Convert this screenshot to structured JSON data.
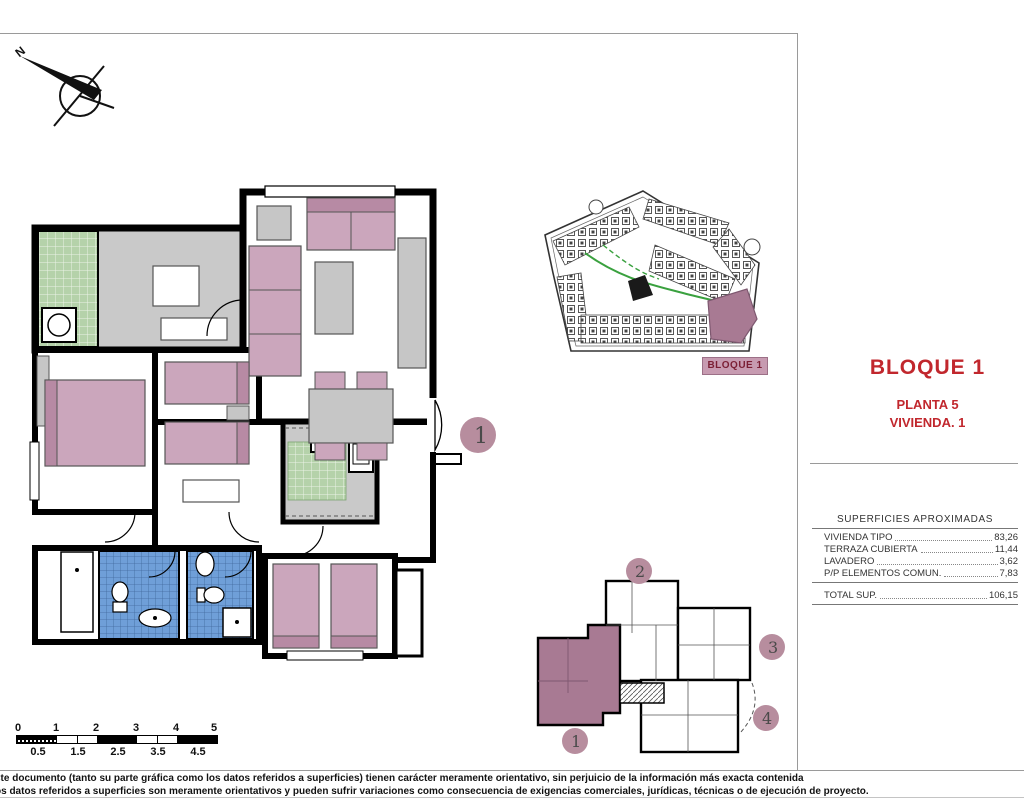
{
  "page": {
    "compass_label": "N"
  },
  "title_block": {
    "bloque": "BLOQUE 1",
    "planta": "PLANTA 5",
    "vivienda": "VIVIENDA. 1"
  },
  "areas_table": {
    "header": "SUPERFICIES APROXIMADAS",
    "rows": [
      {
        "label": "VIVIENDA TIPO",
        "value": "83,26"
      },
      {
        "label": "TERRAZA CUBIERTA",
        "value": "11,44"
      },
      {
        "label": "LAVADERO",
        "value": "3,62"
      },
      {
        "label": "P/P ELEMENTOS COMUN.",
        "value": "7,83"
      }
    ],
    "total": {
      "label": "TOTAL SUP.",
      "value": "106,15"
    }
  },
  "site_plan": {
    "label": "BLOQUE 1"
  },
  "key_plan": {
    "units": [
      "1",
      "2",
      "3",
      "4"
    ],
    "highlighted_unit": "1"
  },
  "unit_badge": "1",
  "scale_bar": {
    "top_labels": [
      "0",
      "1",
      "2",
      "3",
      "4",
      "5"
    ],
    "bottom_labels": [
      "0.5",
      "1.5",
      "2.5",
      "3.5",
      "4.5"
    ]
  },
  "disclaimer": {
    "line1": "ste documento (tanto su parte gráfica como los datos referidos a superficies) tienen carácter meramente orientativo, sin perjuicio de la información más exacta contenida",
    "line2": "os datos referidos a superficies son meramente orientativos y pueden sufrir variaciones como consecuencia de exigencias comerciales, jurídicas, técnicas o de ejecución de proyecto."
  },
  "colors": {
    "accent_red": "#c1272d",
    "badge_mauve": "#b78d9e",
    "unit_highlight": "#a87a93",
    "bed_pink": "#cba6bc",
    "tile_green": "#b5d2aa",
    "tile_blue": "#6f9fd8",
    "path_green": "#3aa13f",
    "label_bg": "#c79bb1"
  }
}
